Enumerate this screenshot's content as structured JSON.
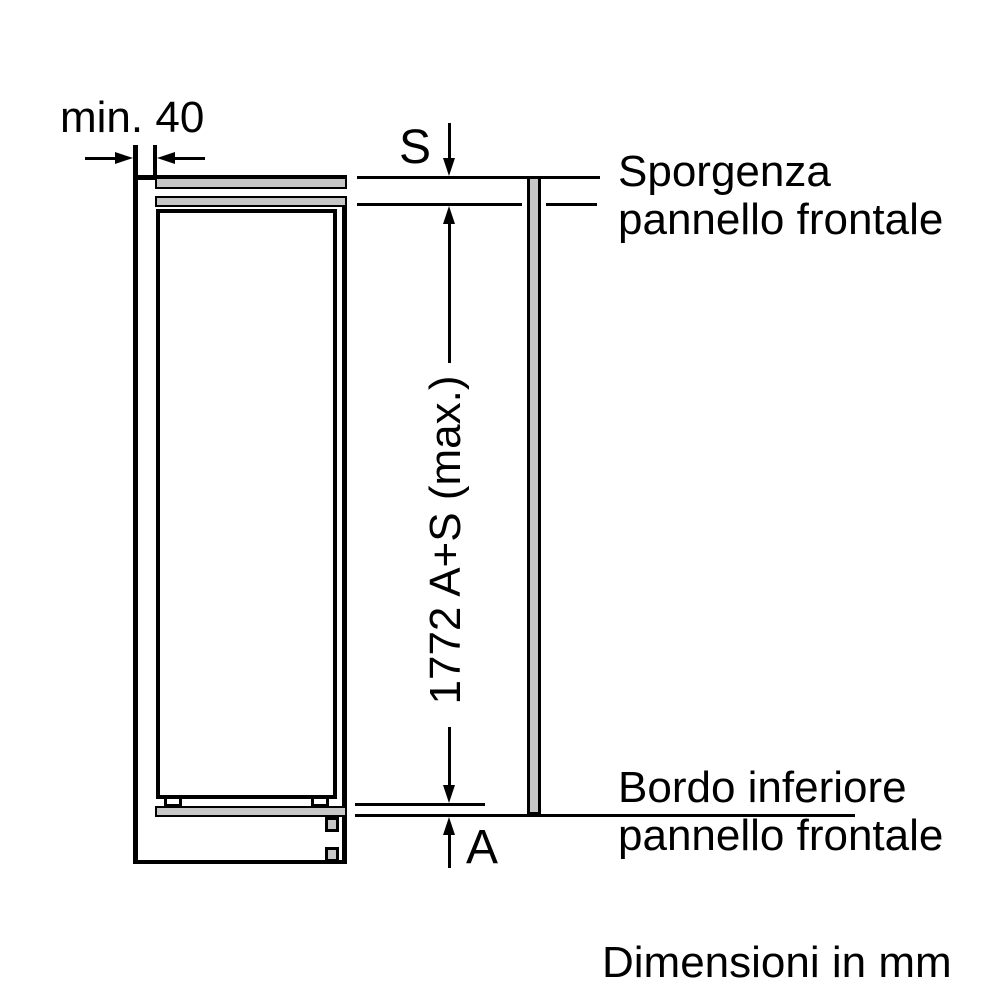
{
  "diagram": {
    "units_note": "Dimensioni in mm",
    "dimensions": {
      "min_gap": "min. 40",
      "protrusion": "S",
      "bottom_offset": "A",
      "overall_height": "1772 A+S (max.)"
    },
    "callouts": {
      "top": {
        "line1": "Sporgenza",
        "line2": "pannello frontale"
      },
      "bottom": {
        "line1": "Bordo inferiore",
        "line2": "pannello frontale"
      }
    },
    "colors": {
      "line": "#000000",
      "panel_fill": "#c7c7c7",
      "background": "#ffffff"
    }
  }
}
